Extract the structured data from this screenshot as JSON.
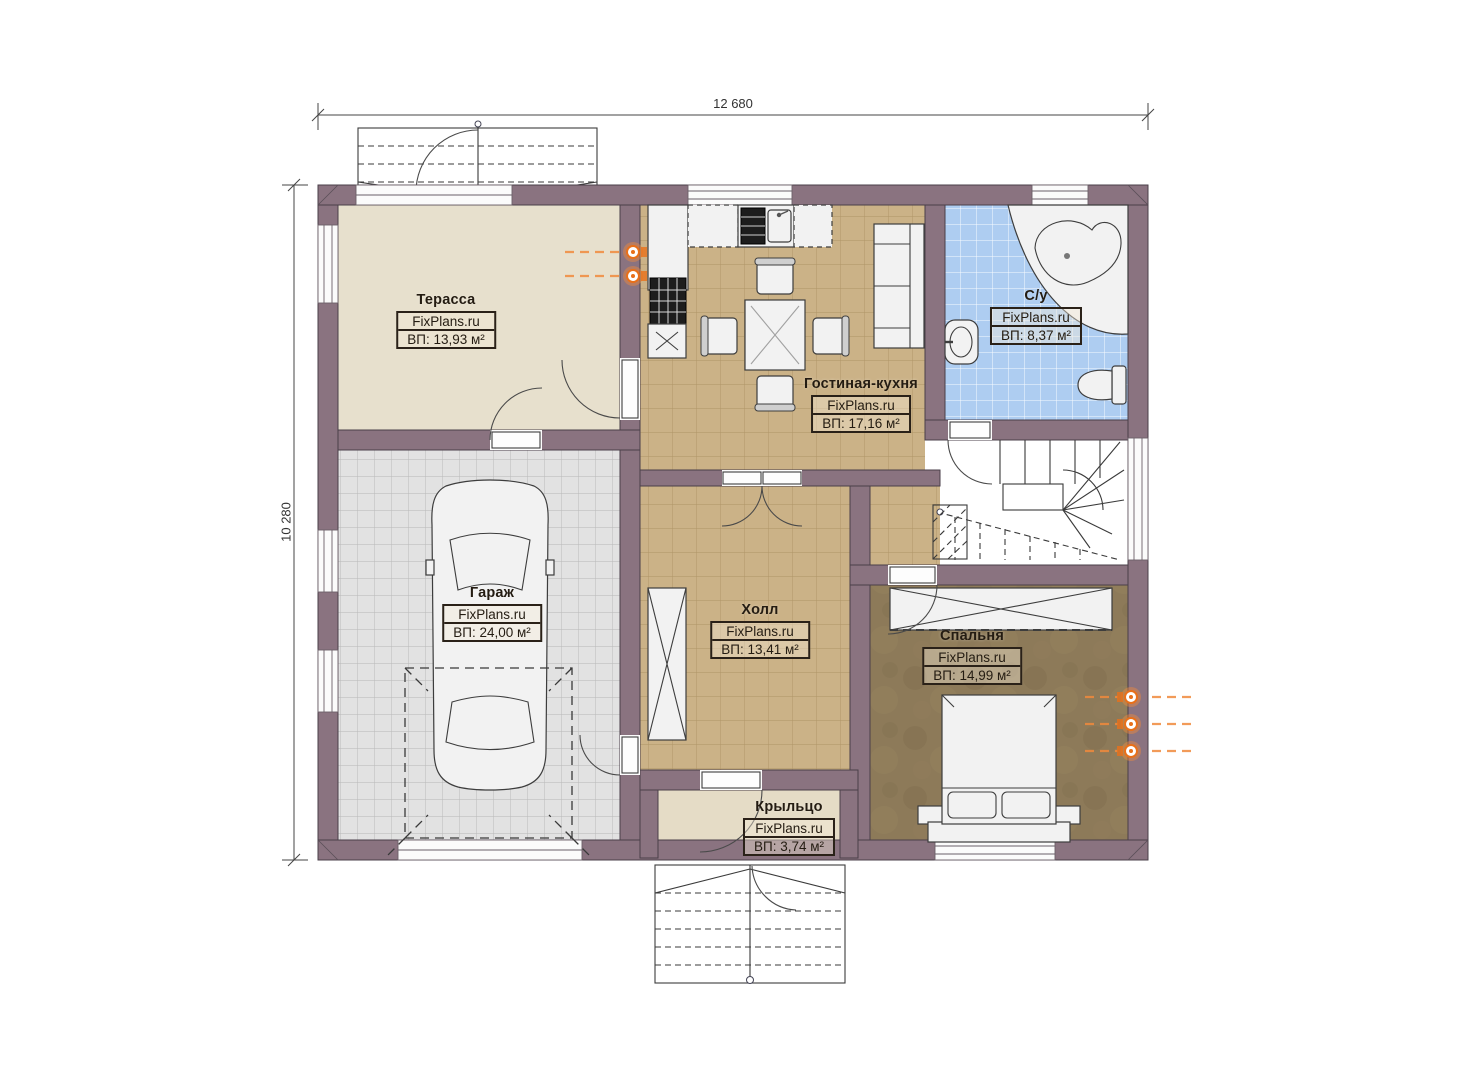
{
  "dimensions": {
    "top": "12 680",
    "left": "10 280"
  },
  "watermark": "FixPlans.ru",
  "rooms": [
    {
      "id": "terrace",
      "name": "Терасса",
      "area": "ВП: 13,93 м²"
    },
    {
      "id": "living-kitchen",
      "name": "Гостиная-кухня",
      "area": "ВП: 17,16 м²"
    },
    {
      "id": "bathroom",
      "name": "С/у",
      "area": "ВП: 8,37 м²"
    },
    {
      "id": "garage",
      "name": "Гараж",
      "area": "ВП: 24,00 м²"
    },
    {
      "id": "hall",
      "name": "Холл",
      "area": "ВП: 13,41 м²"
    },
    {
      "id": "bedroom",
      "name": "Спальня",
      "area": "ВП: 14,99 м²"
    },
    {
      "id": "porch",
      "name": "Крыльцо",
      "area": "ВП: 3,74 м²"
    }
  ],
  "colors": {
    "wall": "#8a7380",
    "floor_tan": "#cbb287",
    "floor_blue": "#aecdf1",
    "floor_gray": "#e2e2e2",
    "floor_brown": "#8d7a59",
    "floor_beige": "#e7e0cd",
    "accent_orange": "#f08a3c"
  }
}
